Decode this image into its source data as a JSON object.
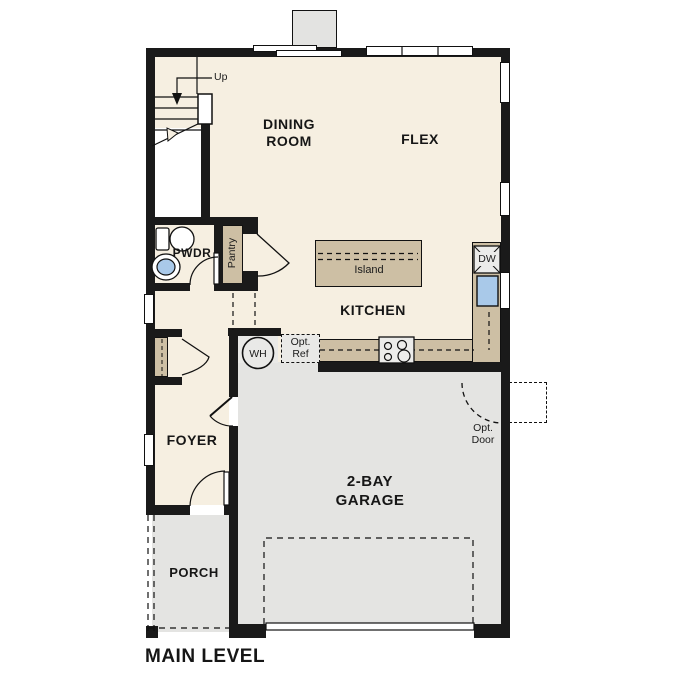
{
  "title": "MAIN LEVEL",
  "labels": {
    "up": "Up",
    "dining_room": "DINING\nROOM",
    "flex": "FLEX",
    "pwdr": "PWDR",
    "pantry": "Pantry",
    "island": "Island",
    "kitchen": "KITCHEN",
    "dw": "DW",
    "wh": "WH",
    "opt_ref": "Opt.\nRef",
    "opt_door": "Opt.\nDoor",
    "foyer": "FOYER",
    "garage": "2-BAY\nGARAGE",
    "porch": "PORCH",
    "main_level": "MAIN LEVEL"
  },
  "colors": {
    "wall": "#1a1a1a",
    "floor": "#f6efe1",
    "cabinet_tan": "#cdbfa4",
    "garage_gray": "#e4e4e2",
    "fixture_gray": "#e9e9e7",
    "sink_blue": "#a9c9e9",
    "chimney_gray": "#e3e3e1"
  }
}
